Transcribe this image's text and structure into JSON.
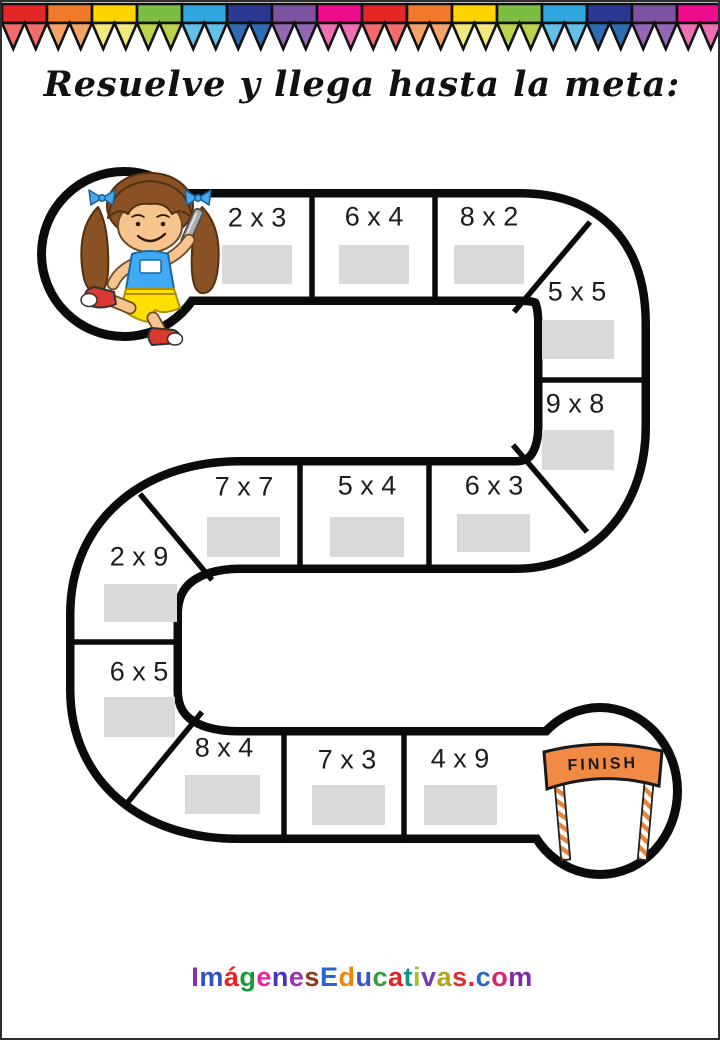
{
  "title": {
    "text": "Resuelve y llega hasta la meta:"
  },
  "banner": {
    "segments": [
      {
        "band": "#E32726",
        "pennant": "#F26C6C"
      },
      {
        "band": "#F3792B",
        "pennant": "#F5A468"
      },
      {
        "band": "#FFD500",
        "pennant": "#F2E97E"
      },
      {
        "band": "#7CBE43",
        "pennant": "#B9D44B"
      },
      {
        "band": "#30A8DF",
        "pennant": "#63BEE8"
      },
      {
        "band": "#2B3990",
        "pennant": "#2E6CB4"
      },
      {
        "band": "#7C52A1",
        "pennant": "#9268B4"
      },
      {
        "band": "#EC0C8C",
        "pennant": "#EE6FB2"
      },
      {
        "band": "#E32726",
        "pennant": "#F26C6C"
      },
      {
        "band": "#F3792B",
        "pennant": "#F5A468"
      },
      {
        "band": "#FFD500",
        "pennant": "#F2E97E"
      },
      {
        "band": "#7CBE43",
        "pennant": "#B9D44B"
      },
      {
        "band": "#30A8DF",
        "pennant": "#63BEE8"
      },
      {
        "band": "#2B3990",
        "pennant": "#2E6CB4"
      },
      {
        "band": "#7C52A1",
        "pennant": "#9268B4"
      },
      {
        "band": "#EC0C8C",
        "pennant": "#EE6FB2"
      }
    ]
  },
  "board": {
    "path_color": "#0b0b0b",
    "answer_box_color": "#d9d9d9",
    "cells": [
      {
        "label": "2 x 3",
        "lx": 255,
        "ly": 216,
        "bx": 220,
        "by": 243,
        "bw": 70,
        "bh": 39
      },
      {
        "label": "6 x 4",
        "lx": 372,
        "ly": 215,
        "bx": 337,
        "by": 243,
        "bw": 70,
        "bh": 39
      },
      {
        "label": "8 x 2",
        "lx": 487,
        "ly": 215,
        "bx": 452,
        "by": 243,
        "bw": 70,
        "bh": 39
      },
      {
        "label": "5 x 5",
        "lx": 575,
        "ly": 290,
        "bx": 540,
        "by": 318,
        "bw": 72,
        "bh": 39
      },
      {
        "label": "9 x 8",
        "lx": 573,
        "ly": 402,
        "bx": 540,
        "by": 428,
        "bw": 72,
        "bh": 40
      },
      {
        "label": "7 x 7",
        "lx": 242,
        "ly": 485,
        "bx": 205,
        "by": 515,
        "bw": 73,
        "bh": 40
      },
      {
        "label": "5 x 4",
        "lx": 365,
        "ly": 484,
        "bx": 328,
        "by": 515,
        "bw": 74,
        "bh": 40
      },
      {
        "label": "6 x 3",
        "lx": 492,
        "ly": 484,
        "bx": 455,
        "by": 512,
        "bw": 73,
        "bh": 38
      },
      {
        "label": "2 x 9",
        "lx": 137,
        "ly": 555,
        "bx": 102,
        "by": 582,
        "bw": 73,
        "bh": 38
      },
      {
        "label": "6 x 5",
        "lx": 137,
        "ly": 670,
        "bx": 102,
        "by": 695,
        "bw": 71,
        "bh": 40
      },
      {
        "label": "8 x 4",
        "lx": 222,
        "ly": 746,
        "bx": 183,
        "by": 773,
        "bw": 75,
        "bh": 39
      },
      {
        "label": "7 x 3",
        "lx": 345,
        "ly": 758,
        "bx": 310,
        "by": 783,
        "bw": 73,
        "bh": 40
      },
      {
        "label": "4 x 9",
        "lx": 458,
        "ly": 757,
        "bx": 422,
        "by": 783,
        "bw": 73,
        "bh": 40
      }
    ]
  },
  "start": {
    "character": "girl-runner"
  },
  "finish": {
    "label": "FINISH",
    "banner_color": "#F08A45"
  },
  "footer": {
    "text": "ImágenesEducativas.com",
    "letters": [
      {
        "ch": "I",
        "color": "#8A2BA8"
      },
      {
        "ch": "m",
        "color": "#3052C8"
      },
      {
        "ch": "á",
        "color": "#E82222"
      },
      {
        "ch": "g",
        "color": "#159A35"
      },
      {
        "ch": "e",
        "color": "#E8259E"
      },
      {
        "ch": "n",
        "color": "#4433BB"
      },
      {
        "ch": "e",
        "color": "#9A30B8"
      },
      {
        "ch": "s",
        "color": "#8A3A14"
      },
      {
        "ch": "E",
        "color": "#2565D8"
      },
      {
        "ch": "d",
        "color": "#EE8503"
      },
      {
        "ch": "u",
        "color": "#3D55C4"
      },
      {
        "ch": "c",
        "color": "#2F9E3C"
      },
      {
        "ch": "a",
        "color": "#DC2626"
      },
      {
        "ch": "t",
        "color": "#0E9488"
      },
      {
        "ch": "i",
        "color": "#A3C229"
      },
      {
        "ch": "v",
        "color": "#7A3BAB"
      },
      {
        "ch": "a",
        "color": "#AFA81F"
      },
      {
        "ch": "s",
        "color": "#DC3030"
      },
      {
        "ch": ".",
        "color": "#E82222"
      },
      {
        "ch": "c",
        "color": "#2E64C8"
      },
      {
        "ch": "o",
        "color": "#D6246E"
      },
      {
        "ch": "m",
        "color": "#7A2BA8"
      }
    ]
  }
}
